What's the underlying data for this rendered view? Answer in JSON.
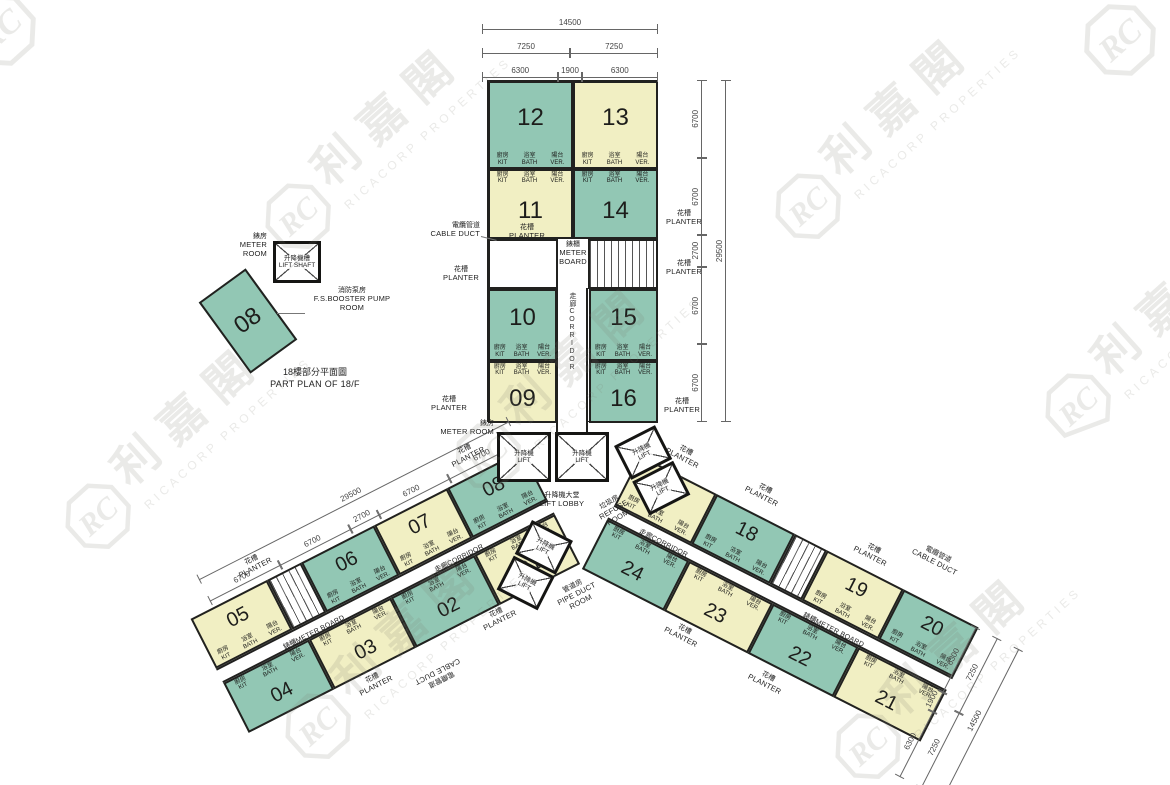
{
  "plan": {
    "caption": {
      "zh": "18樓部分平面圖",
      "en": "PART PLAN OF 18/F"
    }
  },
  "watermark": {
    "zh": "利嘉閣",
    "en": "RICACORP PROPERTIES",
    "logo": "RC"
  },
  "colors": {
    "unit_teal": "#92c7b4",
    "unit_cream": "#f1efc3",
    "wall": "#21211f",
    "dim_text": "#444444"
  },
  "rooms": {
    "kit": {
      "zh": "廚房",
      "en": "KIT"
    },
    "bath": {
      "zh": "浴室",
      "en": "BATH"
    },
    "ver": {
      "zh": "陽台",
      "en": "VER."
    }
  },
  "facilities": {
    "planter": {
      "zh": "花槽",
      "en": "PLANTER"
    },
    "corridor": {
      "zh": "走廊",
      "en": "CORRIDOR"
    },
    "cable_duct": {
      "zh": "電纜管道",
      "en": "CABLE DUCT"
    },
    "meter_board": {
      "zh": "錶櫃",
      "en": "METER BOARD"
    },
    "meter_room": {
      "zh": "錶房",
      "en": "METER ROOM"
    },
    "lift": {
      "zh": "升降機",
      "en": "LIFT"
    },
    "lift_lobby": {
      "zh": "升降機大堂",
      "en": "LIFT LOBBY"
    },
    "lift_shaft": {
      "zh": "升降機槽",
      "en": "LIFT SHAFT"
    },
    "refuse_room": {
      "zh": "垃圾房",
      "en": "REFUSE ROOM"
    },
    "pipe_duct_room": {
      "zh": "管道房",
      "en": "PIPE DUCT ROOM"
    },
    "pump_room": {
      "zh": "消防泵房",
      "en": "F.S.BOOSTER PUMP ROOM"
    }
  },
  "central_units": [
    {
      "no": "12",
      "color": "teal"
    },
    {
      "no": "13",
      "color": "cream"
    },
    {
      "no": "11",
      "color": "cream"
    },
    {
      "no": "14",
      "color": "teal"
    },
    {
      "no": "10",
      "color": "teal"
    },
    {
      "no": "15",
      "color": "teal"
    },
    {
      "no": "09",
      "color": "cream"
    },
    {
      "no": "16",
      "color": "teal"
    }
  ],
  "left_wing": {
    "top_row": [
      {
        "no": "05",
        "color": "cream"
      },
      {
        "no": "06",
        "color": "teal"
      },
      {
        "no": "07",
        "color": "cream"
      },
      {
        "no": "08",
        "color": "teal"
      }
    ],
    "bottom_row": [
      {
        "no": "04",
        "color": "teal"
      },
      {
        "no": "03",
        "color": "cream"
      },
      {
        "no": "02",
        "color": "teal"
      },
      {
        "no": "01",
        "color": "cream"
      }
    ]
  },
  "right_wing": {
    "top_row": [
      {
        "no": "17",
        "color": "cream"
      },
      {
        "no": "18",
        "color": "teal"
      },
      {
        "no": "19",
        "color": "cream"
      },
      {
        "no": "20",
        "color": "teal"
      }
    ],
    "bottom_row": [
      {
        "no": "24",
        "color": "teal"
      },
      {
        "no": "23",
        "color": "cream"
      },
      {
        "no": "22",
        "color": "teal"
      },
      {
        "no": "21",
        "color": "cream"
      }
    ]
  },
  "part_plan_unit": {
    "no": "08",
    "color": "teal"
  },
  "dimensions": {
    "top": {
      "total": "14500",
      "halves": [
        "7250",
        "7250"
      ],
      "inner": [
        "6300",
        "1900",
        "6300"
      ]
    },
    "right_side": {
      "total": "29500",
      "segments": [
        "6700",
        "6700",
        "2700",
        "6700",
        "6700"
      ]
    },
    "left_wing": {
      "total": "29500",
      "segments": [
        "6700",
        "6700",
        "2700",
        "6700",
        "6700"
      ]
    },
    "right_wing_end": {
      "total": "14500",
      "halves": [
        "7250",
        "7250"
      ],
      "inner": [
        "6300",
        "1900",
        "6300"
      ]
    }
  }
}
